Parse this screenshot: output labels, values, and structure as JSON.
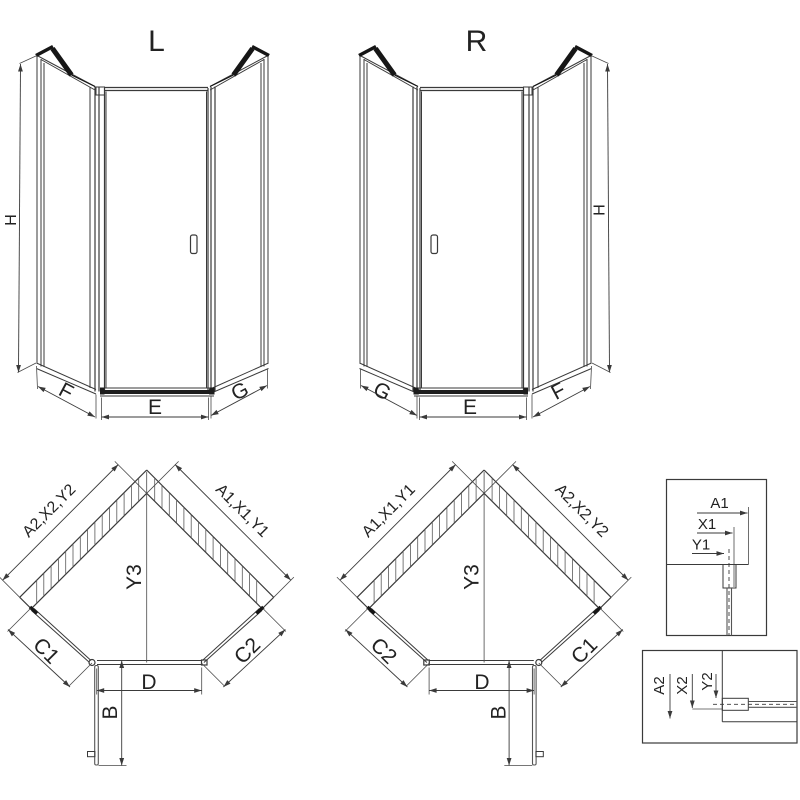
{
  "colors": {
    "background": "#ffffff",
    "line": "#3a3a3a",
    "thick_frame": "#161616",
    "text": "#222222"
  },
  "views": {
    "elevation_left": {
      "title": "L",
      "dim_height": "H",
      "dim_side_left": "F",
      "dim_door": "E",
      "dim_side_right": "G"
    },
    "elevation_right": {
      "title": "R",
      "dim_height": "H",
      "dim_side_left": "G",
      "dim_door": "E",
      "dim_side_right": "F"
    },
    "plan_left": {
      "dim_wall_left": "A2,X2,Y2",
      "dim_wall_right": "A1,X1,Y1",
      "dim_depth": "Y3",
      "dim_side_left": "C1",
      "dim_side_right": "C2",
      "dim_door_width": "D",
      "dim_door_open": "B"
    },
    "plan_right": {
      "dim_wall_left": "A1,X1,Y1",
      "dim_wall_right": "A2,X2,Y2",
      "dim_depth": "Y3",
      "dim_side_left": "C2",
      "dim_side_right": "C1",
      "dim_door_width": "D",
      "dim_door_open": "B"
    },
    "detail_top": {
      "dims": [
        "A1",
        "X1",
        "Y1"
      ]
    },
    "detail_bottom": {
      "dims": [
        "A2",
        "X2",
        "Y2"
      ]
    }
  }
}
